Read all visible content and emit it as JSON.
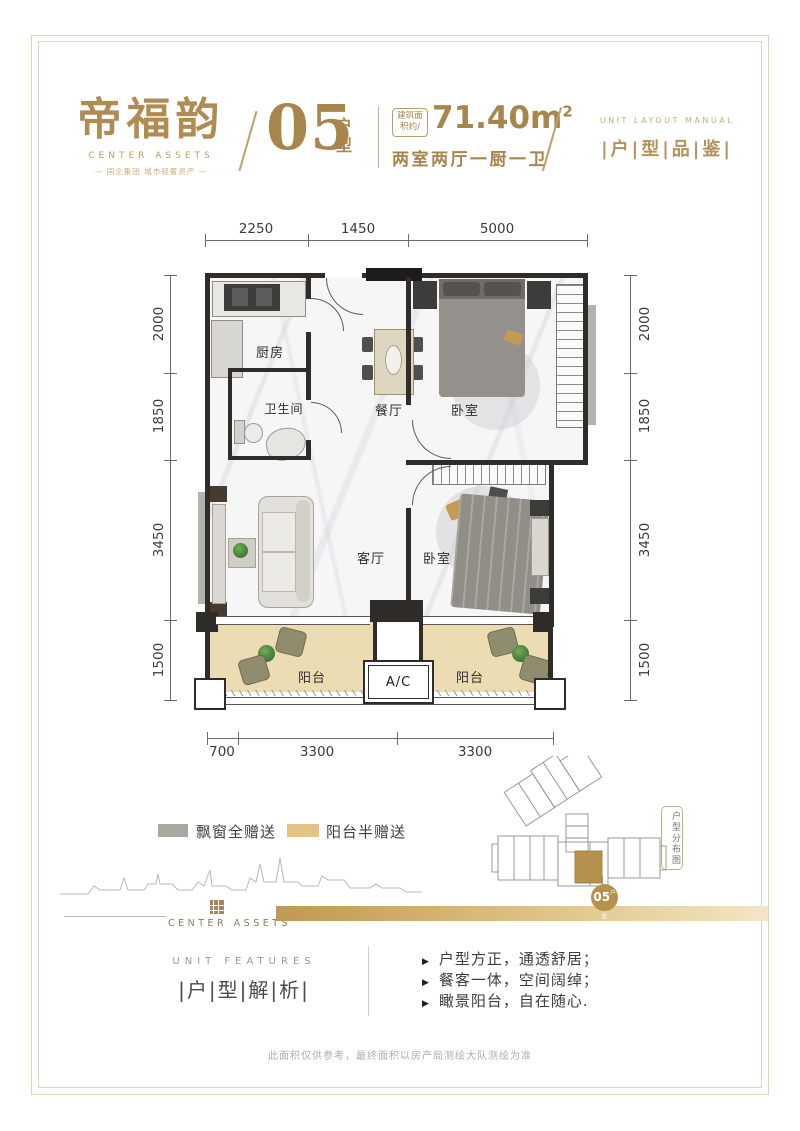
{
  "header": {
    "logo_title": "帝福韵",
    "logo_subtitle": "CENTER ASSETS",
    "logo_tagline": "— 国企集团  城市轻奢资产 —",
    "unit_number": "05",
    "unit_suffix": "户型",
    "area_label": "建筑面积约/",
    "area_value": "71.40m",
    "area_exponent": "2",
    "layout_desc": "两室两厅一厨一卫",
    "right_en": "UNIT LAYOUT MANUAL",
    "right_cn": "|户|型|品|鉴|"
  },
  "plan": {
    "dims_top": [
      "2250",
      "1450",
      "5000"
    ],
    "dims_left": [
      "2000",
      "1850",
      "3450",
      "1500"
    ],
    "dims_right": [
      "2000",
      "1850",
      "3450",
      "1500"
    ],
    "dims_bottom": [
      "700",
      "3300",
      "3300"
    ],
    "rooms": {
      "kitchen": "厨房",
      "bathroom": "卫生间",
      "dining": "餐厅",
      "bedroom_top": "卧室",
      "living": "客厅",
      "bedroom_bottom": "卧室",
      "balcony_left": "阳台",
      "ac": "A/C",
      "balcony_right": "阳台"
    }
  },
  "legend": {
    "items": [
      {
        "label": "飘窗全赠送",
        "color": "#a9a7a2"
      },
      {
        "label": "阳台半赠送",
        "color": "#e5c286"
      }
    ]
  },
  "brand": {
    "name": "CENTER ASSETS"
  },
  "siteplan": {
    "badge_number": "05",
    "badge_suffix": "户型",
    "side_label": "户型分布图",
    "highlight_color": "#b5914e"
  },
  "features": {
    "en": "UNIT FEATURES",
    "cn": "|户|型|解|析|",
    "items": [
      "户型方正，通透舒居；",
      "餐客一体，空间阔绰；",
      "瞰景阳台，自在随心."
    ]
  },
  "footer": {
    "disclaimer": "此面积仅供参考，最终面积以房产局测绘大队测绘为准"
  },
  "colors": {
    "gold": "#a8854c",
    "gold_light": "#e5c286",
    "swatch_gray": "#a9a7a2",
    "wall": "#2f2c29",
    "balcony_floor": "#ecdcb4"
  }
}
